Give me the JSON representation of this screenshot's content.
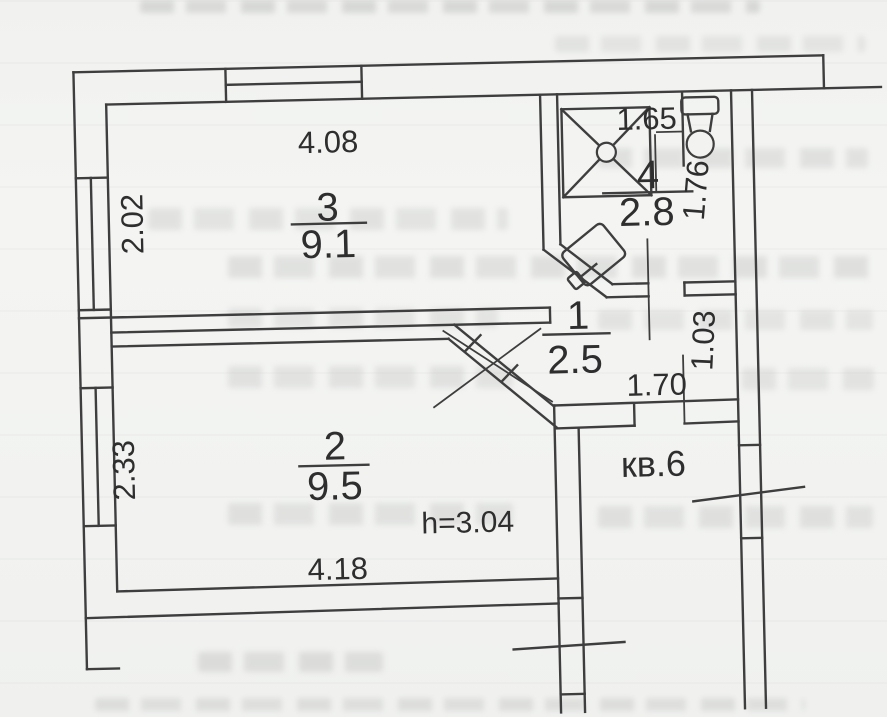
{
  "plan": {
    "apartment_label": "кв.6",
    "ceiling_height_label": "h=3.04",
    "rooms": [
      {
        "number": "3",
        "area": "9.1"
      },
      {
        "number": "4",
        "area": "2.8"
      },
      {
        "number": "1",
        "area": "2.5"
      },
      {
        "number": "2",
        "area": "9.5"
      }
    ],
    "dimensions": {
      "room3_top": "4.08",
      "room3_left": "2.02",
      "room4_top": "1.65",
      "room4_right": "1.76",
      "hall_bottom": "1.70",
      "corridor_right": "1.03",
      "room2_left": "2.33",
      "room2_bottom": "4.18"
    },
    "fixtures": {
      "shower": "shower",
      "toilet": "toilet",
      "sink": "sink"
    },
    "colors": {
      "paper": "#f2f3f1",
      "ink": "#3e3e3e",
      "ghost_text": "#c6c7c5"
    }
  }
}
